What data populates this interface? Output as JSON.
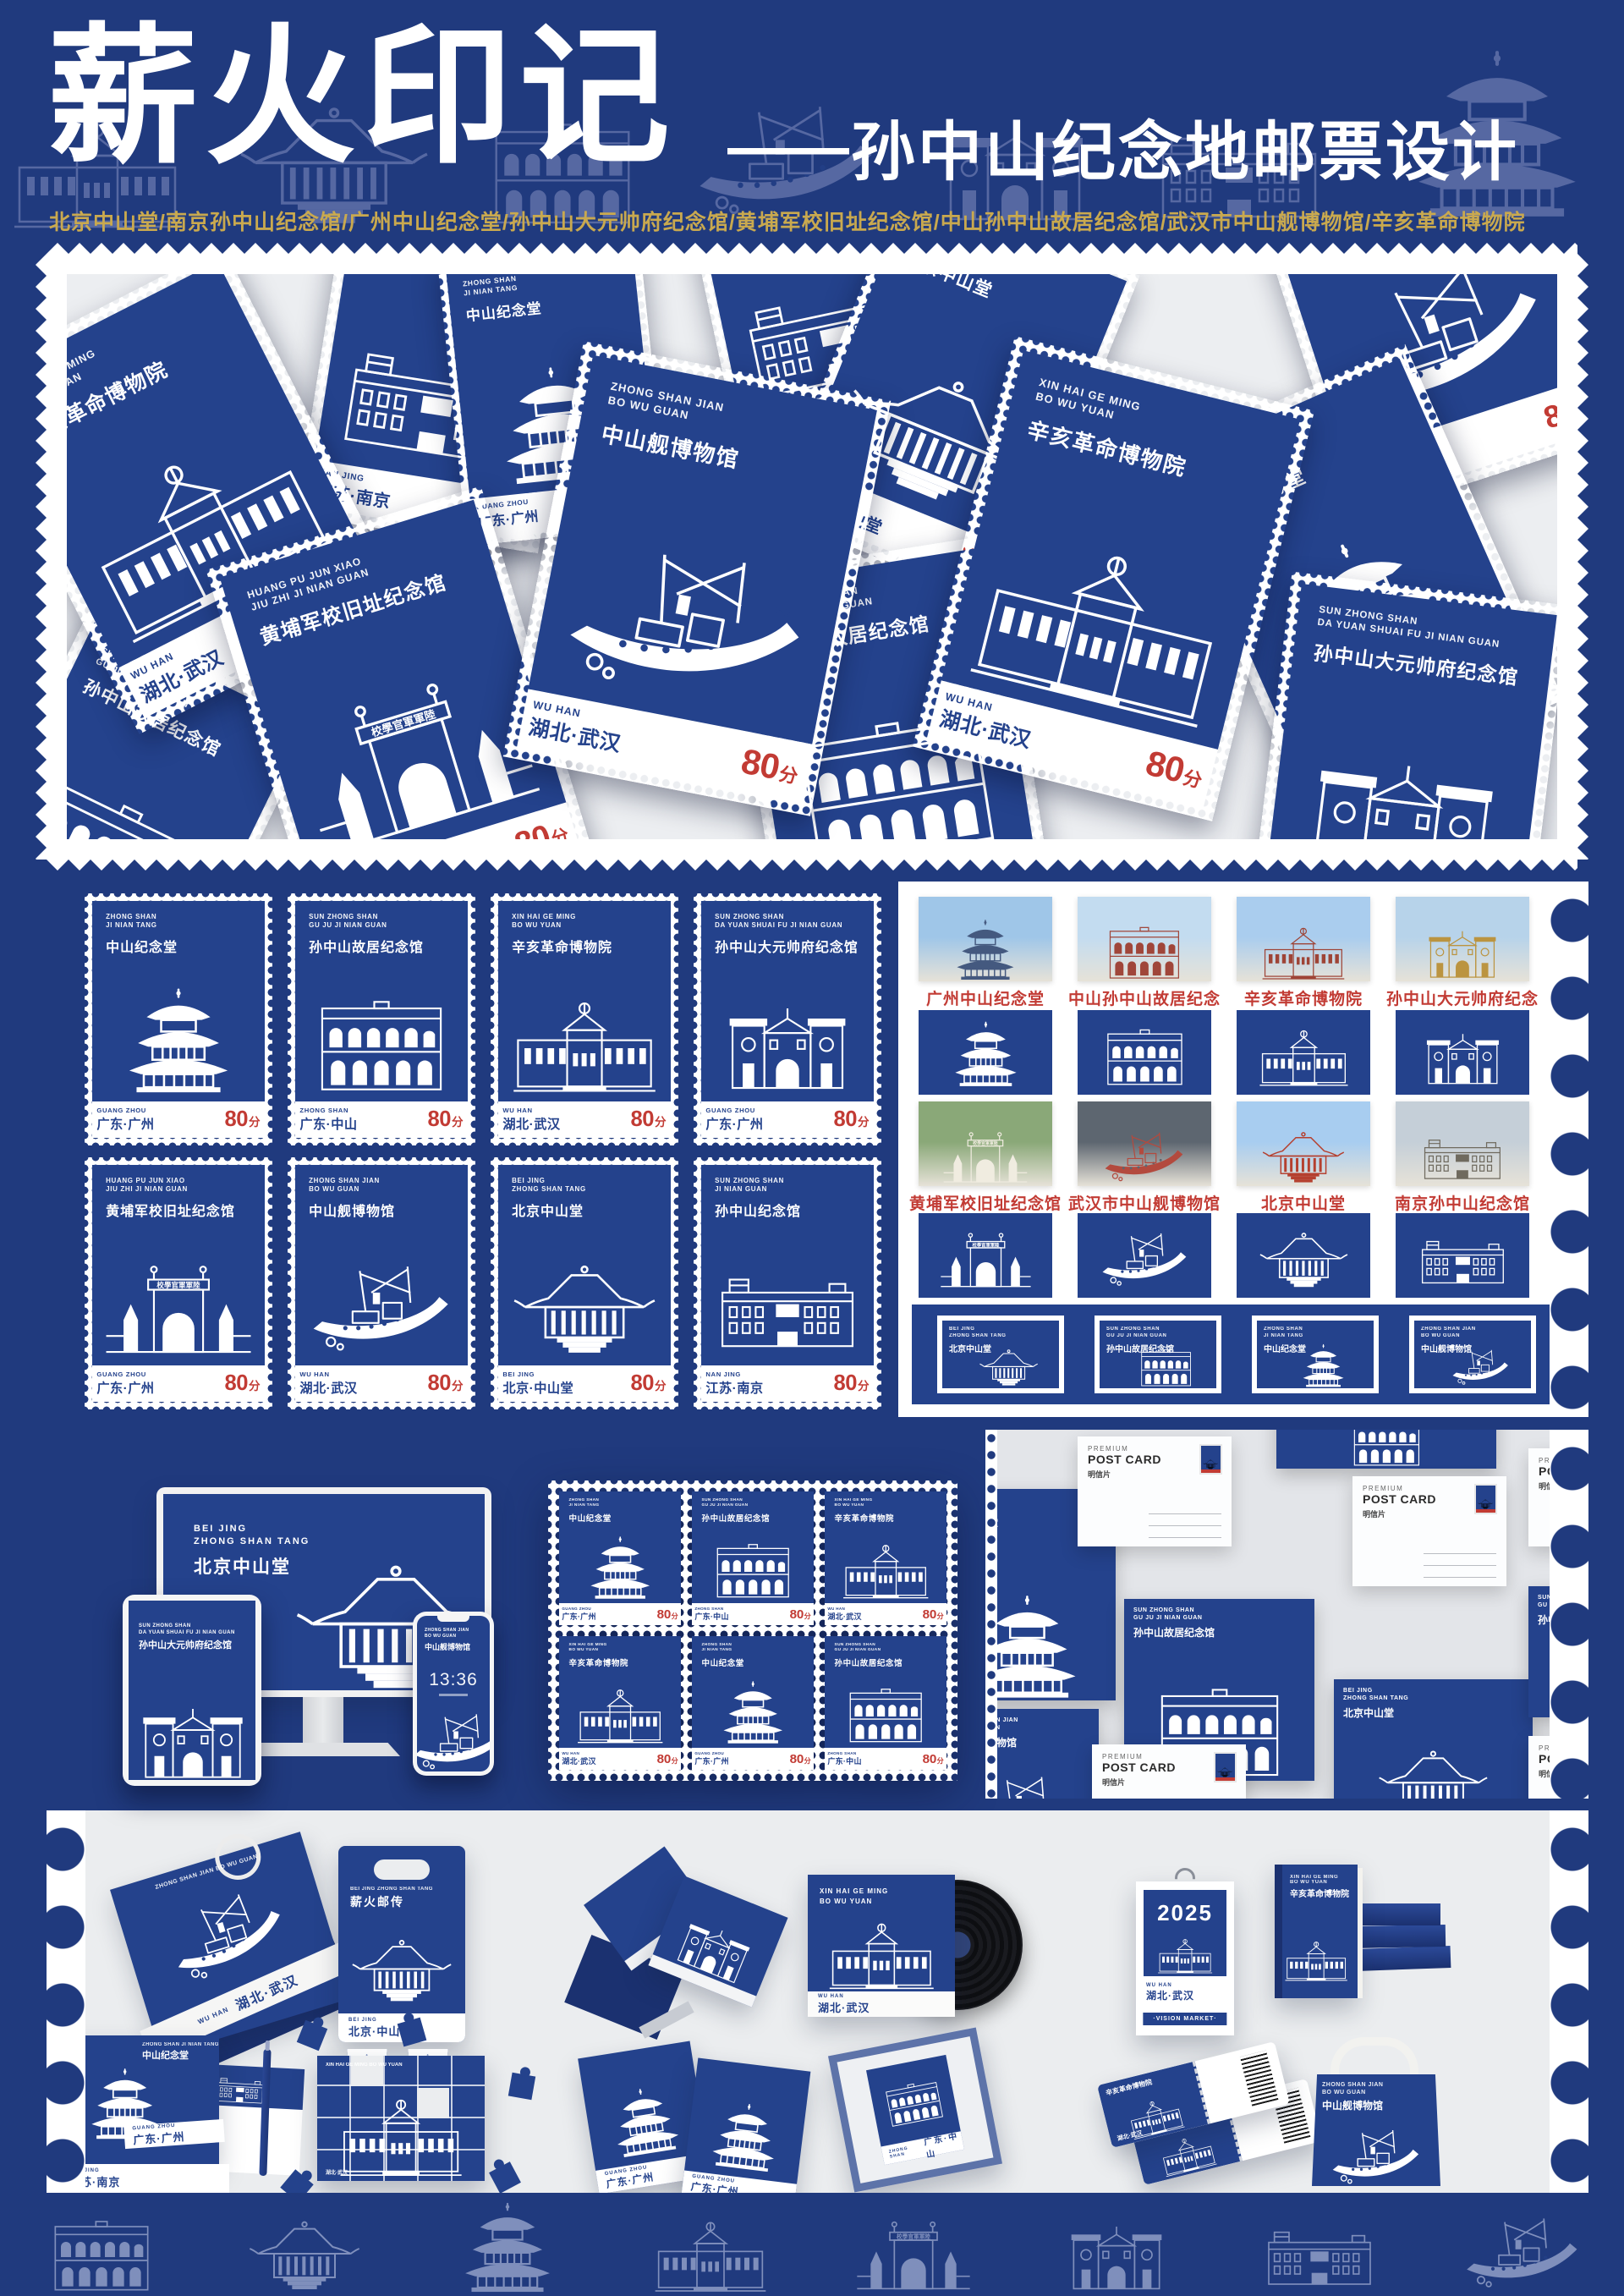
{
  "colors": {
    "navy": "#203a7e",
    "stamp_blue": "#24428c",
    "red": "#c23b34",
    "gold": "#c9a94f"
  },
  "header": {
    "title": "薪火印记",
    "subtitle_dash": "——",
    "subtitle": "孙中山纪念地邮票设计",
    "locations": "北京中山堂/南京孙中山纪念馆/广州中山纪念堂/孙中山大元帅府纪念馆/黄埔军校旧址纪念馆/中山孙中山故居纪念馆/武汉市中山舰博物馆/辛亥革命博物院"
  },
  "stamp_value": {
    "num": "80",
    "unit": "分"
  },
  "archway_banner": "校學官軍軍陸",
  "stamp_types": {
    "jnt": {
      "en1": "ZHONG SHAN",
      "en2": "JI NIAN TANG",
      "zh": "中山纪念堂",
      "building": "pagoda"
    },
    "guju": {
      "en1": "SUN ZHONG SHAN",
      "en2": "GU JU JI NIAN GUAN",
      "zh": "孙中山故居纪念馆",
      "building": "colonnade"
    },
    "xinhai": {
      "en1": "XIN HAI GE MING",
      "en2": "BO WU YUAN",
      "zh": "辛亥革命博物院",
      "building": "western"
    },
    "dys": {
      "en1": "SUN ZHONG SHAN",
      "en2": "DA YUAN SHUAI FU JI NIAN GUAN",
      "zh": "孙中山大元帅府纪念馆",
      "building": "gate"
    },
    "hp": {
      "en1": "HUANG PU JUN XIAO",
      "en2": "JIU ZHI JI NIAN GUAN",
      "zh": "黄埔军校旧址纪念馆",
      "building": "archway"
    },
    "jian": {
      "en1": "ZHONG SHAN JIAN",
      "en2": "BO WU GUAN",
      "zh": "中山舰博物馆",
      "building": "ship",
      "hull_mark": "山中"
    },
    "bj": {
      "en1": "BEI JING",
      "en2": "ZHONG SHAN TANG",
      "zh": "北京中山堂",
      "building": "hall"
    },
    "nj": {
      "en1": "SUN ZHONG SHAN",
      "en2": "JI NIAN GUAN",
      "zh": "孙中山纪念馆",
      "building": "modern"
    }
  },
  "regions": {
    "gz": {
      "en": "GUANG ZHOU",
      "zh": "广东·广州"
    },
    "zs": {
      "en": "ZHONG SHAN",
      "zh": "广东·中山"
    },
    "wh": {
      "en": "WU HAN",
      "zh": "湖北·武汉"
    },
    "bj": {
      "en": "BEI JING",
      "zh": "北京·中山堂"
    },
    "nj": {
      "en": "NAN JING",
      "zh": "江苏·南京"
    }
  },
  "collage_stamps": [
    {
      "type": "xinhai",
      "region": "wh"
    },
    {
      "type": "nj",
      "region": "nj"
    },
    {
      "type": "jnt",
      "region": "gz"
    },
    {
      "type": "jian",
      "region": "wh"
    },
    {
      "type": "hp",
      "region": "gz"
    },
    {
      "type": "bj",
      "region": "bj"
    },
    {
      "type": "xinhai",
      "region": "wh"
    },
    {
      "type": "guju",
      "region": "zs"
    },
    {
      "type": "jnt",
      "region": "gz"
    },
    {
      "type": "dys",
      "region": "gz"
    },
    {
      "type": "jian",
      "region": "wh"
    },
    {
      "type": "guju",
      "region": "zs"
    },
    {
      "type": "nj",
      "region": "nj"
    }
  ],
  "grid_stamps": [
    {
      "type": "jnt",
      "region": "gz"
    },
    {
      "type": "guju",
      "region": "zs"
    },
    {
      "type": "xinhai",
      "region": "wh"
    },
    {
      "type": "dys",
      "region": "gz"
    },
    {
      "type": "hp",
      "region": "gz"
    },
    {
      "type": "jian",
      "region": "wh"
    },
    {
      "type": "bj",
      "region": "bj"
    },
    {
      "type": "nj",
      "region": "nj"
    }
  ],
  "photos": [
    {
      "caption": "广州中山纪念堂",
      "building": "pagoda"
    },
    {
      "caption": "中山孙中山故居纪念馆",
      "building": "colonnade"
    },
    {
      "caption": "辛亥革命博物院",
      "building": "western"
    },
    {
      "caption": "孙中山大元帅府纪念馆",
      "building": "gate"
    },
    {
      "caption": "黄埔军校旧址纪念馆",
      "building": "archway"
    },
    {
      "caption": "武汉市中山舰博物馆",
      "building": "ship"
    },
    {
      "caption": "北京中山堂",
      "building": "hall"
    },
    {
      "caption": "南京孙中山纪念馆",
      "building": "modern"
    }
  ],
  "tiles": [
    "pagoda",
    "colonnade",
    "western",
    "gate",
    "archway",
    "ship",
    "hall",
    "modern"
  ],
  "banner_cards": [
    {
      "type": "bj"
    },
    {
      "type": "guju"
    },
    {
      "type": "jnt"
    },
    {
      "type": "jian"
    }
  ],
  "sheet_stamps": [
    {
      "type": "jnt",
      "region": "gz"
    },
    {
      "type": "guju",
      "region": "zs"
    },
    {
      "type": "xinhai",
      "region": "wh"
    },
    {
      "type": "xinhai",
      "region": "wh"
    },
    {
      "type": "jnt",
      "region": "gz"
    },
    {
      "type": "guju",
      "region": "zs"
    }
  ],
  "devices": {
    "monitor": {
      "en1": "BEI JING",
      "en2": "ZHONG SHAN TANG",
      "zh": "北京中山堂",
      "building": "hall"
    },
    "tablet": {
      "en1": "SUN ZHONG SHAN",
      "en2": "DA YUAN SHUAI FU JI NIAN GUAN",
      "zh": "孙中山大元帅府纪念馆",
      "building": "gate"
    },
    "phone": {
      "en1": "ZHONG SHAN JIAN",
      "en2": "BO WU GUAN",
      "zh": "中山舰博物馆",
      "time": "13:36",
      "building": "ship"
    }
  },
  "postcard": {
    "line1": "PREMIUM",
    "line2": "POST CARD",
    "line3": "明信片"
  },
  "postcard_blue": [
    {
      "type": "jnt"
    },
    {
      "type": "guju"
    },
    {
      "type": "bj"
    },
    {
      "type": "guju"
    },
    {
      "type": "jian"
    },
    {
      "type": "guju"
    }
  ],
  "merch": {
    "bag": {
      "en": "ZHONG SHAN JIAN BO WU GUAN",
      "zh": "中山舰博物馆",
      "region_en": "WU HAN",
      "region": "湖北·武汉"
    },
    "carrier": {
      "en": "BEI JING ZHONG SHAN TANG",
      "title": "薪火邮传",
      "region_en": "BEI JING",
      "region": "北京·中山堂"
    },
    "envelope": {
      "en": "ZHONG SHAN JI NIAN TANG",
      "zh": "中山纪念堂",
      "region_en": "GUANG ZHOU",
      "region": "广东·广州",
      "backing_region_en": "NAN JING",
      "backing_region": "江苏·南京"
    },
    "puzzle": {
      "en": "XIN HAI GE MING BO WU YUAN",
      "region": "湖北·武汉"
    },
    "vinyl": {
      "en1": "XIN HAI GE MING",
      "en2": "BO WU YUAN",
      "region_en": "WU HAN",
      "region": "湖北·武汉"
    },
    "brochure": {
      "region_en": "GUANG ZHOU",
      "region": "广东·广州"
    },
    "frame": {
      "en": "ZHONG SHAN",
      "region": "广东·中山"
    },
    "calendar": {
      "year": "2025",
      "region_en": "WU HAN",
      "region": "湖北·武汉",
      "badge": "·VISION MARKET·"
    },
    "book": {
      "en1": "XIN HAI GE MING",
      "en2": "BO WU YUAN",
      "zh": "辛亥革命博物院"
    },
    "ticket": {
      "zh": "辛亥革命博物院",
      "region": "湖北·武汉"
    },
    "tote": {
      "en1": "ZHONG SHAN JIAN",
      "en2": "BO WU GUAN",
      "zh": "中山舰博物馆"
    }
  }
}
